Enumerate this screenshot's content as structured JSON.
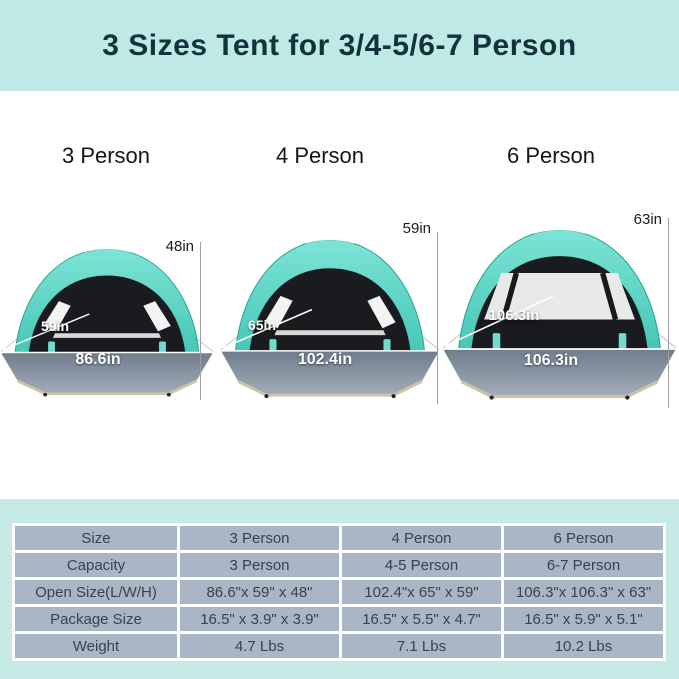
{
  "header": {
    "title": "3 Sizes Tent for 3/4-5/6-7 Person"
  },
  "tents": [
    {
      "label": "3 Person",
      "height_label": "48in",
      "depth_label": "59in",
      "width_label": "86.6in"
    },
    {
      "label": "4 Person",
      "height_label": "59in",
      "depth_label": "65in",
      "width_label": "102.4in"
    },
    {
      "label": "6 Person",
      "height_label": "63in",
      "depth_label": "106.3in",
      "width_label": "106.3in"
    }
  ],
  "table": {
    "rows": [
      {
        "label": "Size",
        "values": [
          "3 Person",
          "4 Person",
          "6 Person"
        ]
      },
      {
        "label": "Capacity",
        "values": [
          "3 Person",
          "4-5 Person",
          "6-7 Person"
        ]
      },
      {
        "label": "Open Size(L/W/H)",
        "values": [
          "86.6\"x 59\" x 48\"",
          "102.4\"x 65\" x 59\"",
          "106.3\"x 106.3\" x 63\""
        ]
      },
      {
        "label": "Package Size",
        "values": [
          "16.5\" x 3.9\" x 3.9\"",
          "16.5\" x 5.5\" x 4.7\"",
          "16.5\" x 5.9\" x 5.1\""
        ]
      },
      {
        "label": "Weight",
        "values": [
          "4.7 Lbs",
          "7.1 Lbs",
          "10.2 Lbs"
        ]
      }
    ]
  },
  "colors": {
    "header_bg": "#bfe9e4",
    "title_text": "#14323c",
    "canopy_teal": "#5fd6c6",
    "floor_gray": "#8a96a4",
    "table_bg": "#c6ebe7",
    "cell_bg": "#a9b6c5",
    "cell_text": "#37424f"
  }
}
